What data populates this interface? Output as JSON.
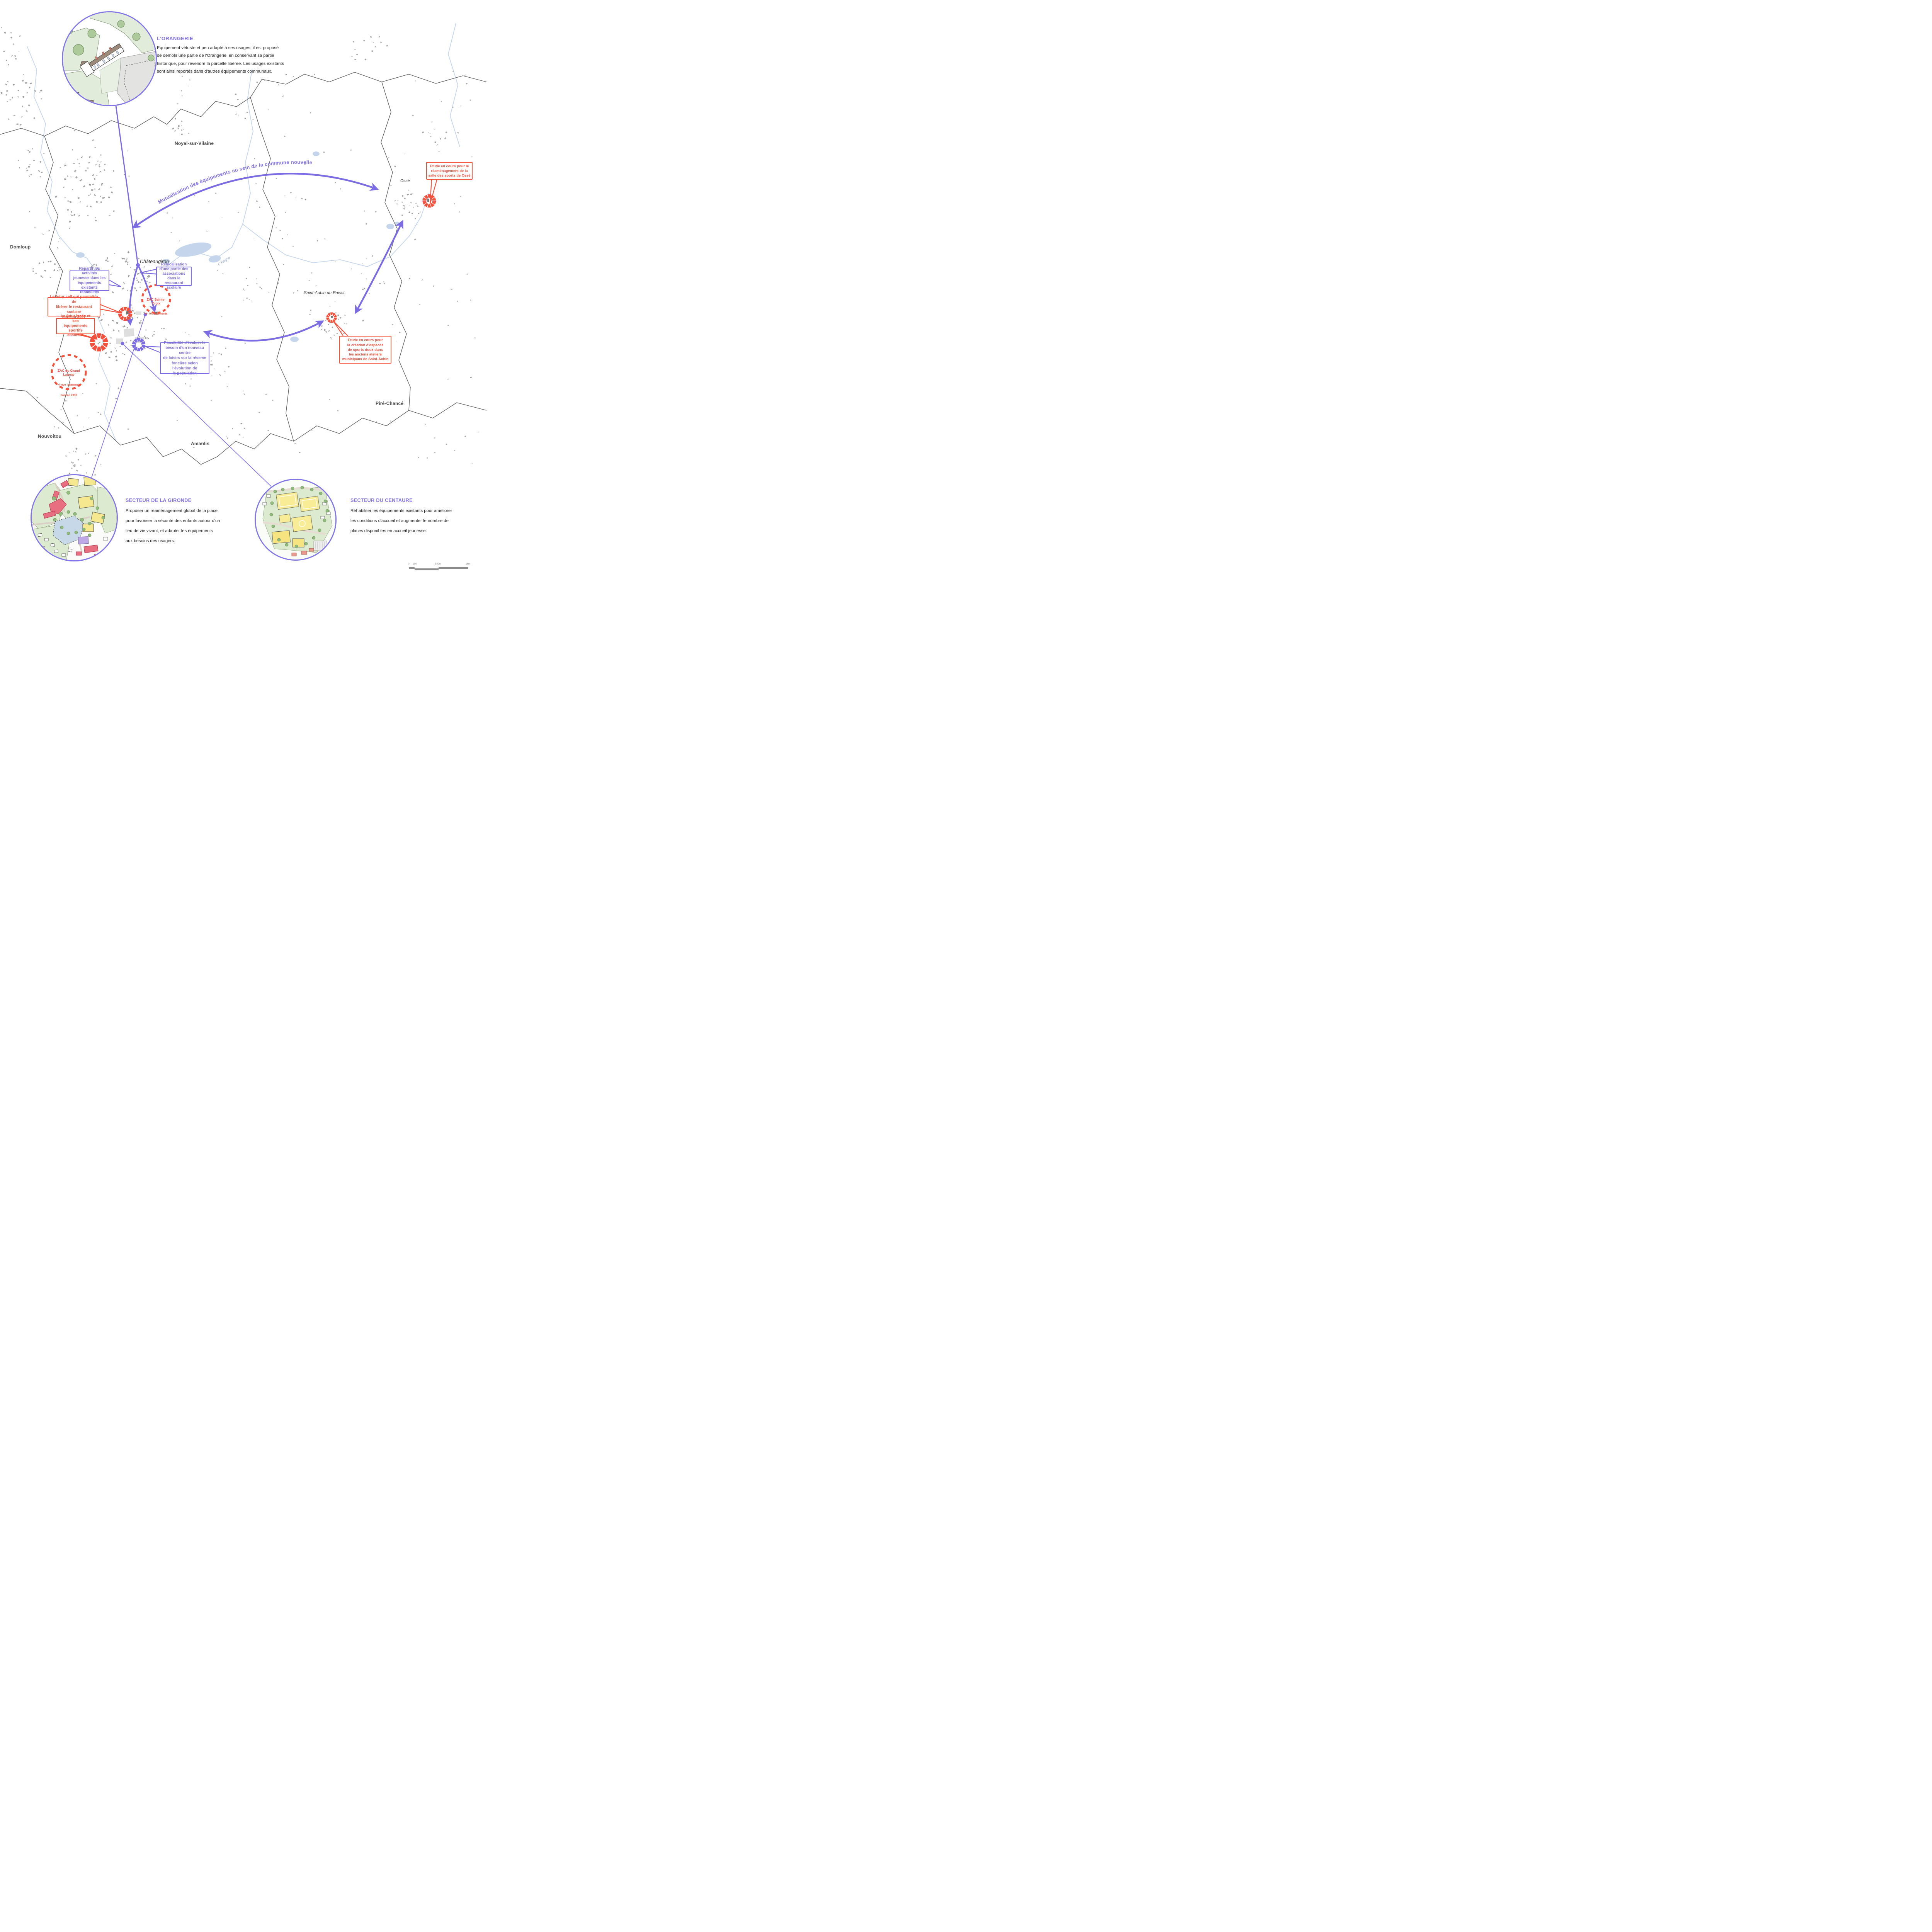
{
  "colors": {
    "accent_purple": "#7c6ce4",
    "accent_red": "#f4513c",
    "map_building_gray": "#a6a6a6",
    "boundary_gray": "#4d4d4d",
    "river_blue": "#c5d6ec"
  },
  "arc_title": "Mutualisation des équipements au sein de la commune nouvelle",
  "places": {
    "noyal": "Noyal-sur-Vilaine",
    "domloup": "Domloup",
    "chateaugiron": "Châteaugiron",
    "osse": "Ossé",
    "saint_aubin": "Saint-Aubin du Pavail",
    "pire": "Piré-Chancé",
    "nouvoitou": "Nouvoitou",
    "amanlis": "Amanlis",
    "river": "L'Yaigne"
  },
  "sections": {
    "orangerie": {
      "title": "L'ORANGERIE",
      "body": "Equipement vétuste et peu adapté à ses usages, il est proposé\nde démolir une partie de l'Orangerie, en conservant sa partie\nhistorique, pour revendre la parcelle libérée. Les usages existants\nsont ainsi reportés dans d'autres équipements communaux."
    },
    "gironde": {
      "title": "SECTEUR DE LA GIRONDE",
      "body": "Proposer un réaménagement global de la place\npour favoriser la sécurité des enfants autour d'un\nlieu de vie vivant, et adapter les équipements\naux besoins des usagers."
    },
    "centaure": {
      "title": "SECTEUR DU CENTAURE",
      "body": "Réhabiliter les équipements existants pour améliorer\nles conditions d'accueil et augmenter le nombre de\nplaces disponibles en accueil jeunesse."
    }
  },
  "callouts": {
    "repartir": "Répartir les activités\njeunesse dans les\néquipements existants\nréhabilités",
    "relocalisation": "Relocalisation\nd'une partie des\nassociations dans le\nrestaurant scolaire",
    "possibilite": "Possibilité d'évaluer le\nbesoin d'un nouveau centre\nde loisirs sur la réserve\nfoncière selon l'évolution de\nla population",
    "futur_self": "Le futur self qui permettra de\nlibérer le restaurant scolaire\nhorizon 2027",
    "futur_lycee": "Le futur lycée et ses\néquipements sportifs\nassociés",
    "etude_osse": "Etude en cours pour le\nréaménagement de la\nsalle des sports de Ossé",
    "etude_saint_aubin": "Etude en cours pour\nla création d'espaces\nde sports doux dans\nles anciens ateliers\nmunicipaux de Saint-Aubin"
  },
  "zac": {
    "sainte_croix": {
      "name": "ZAC Sainte-\nCroix",
      "sub": "+/- 400 logements"
    },
    "grand_launay": {
      "name": "ZAC du Grand\nLaunay",
      "sub": "+/- 900 logements",
      "sub2": "horizon 2035"
    }
  },
  "scalebar": {
    "t0": "0",
    "t100": "100",
    "t500": "500m",
    "t1km": "1km"
  }
}
